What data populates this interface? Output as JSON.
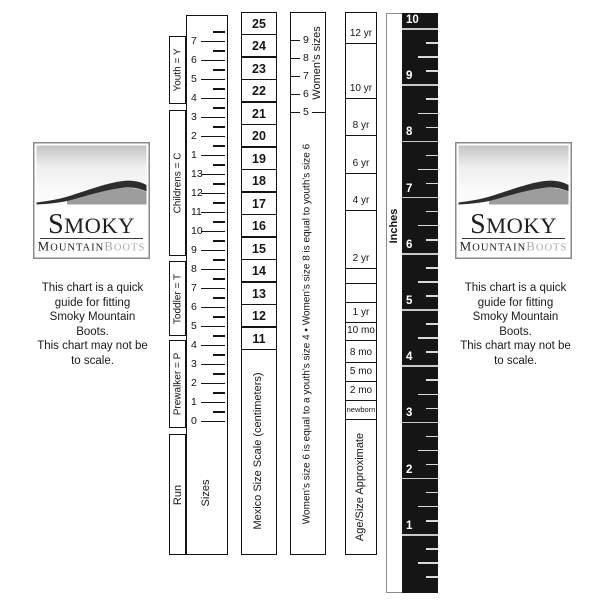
{
  "brand": {
    "name_primary": "Smoky",
    "name_secondary": "Mountain",
    "name_tertiary": "Boots"
  },
  "caption": {
    "lines": [
      "This chart is a quick",
      "guide for fitting",
      "Smoky Mountain",
      "Boots.",
      "This chart may not be",
      "to scale."
    ]
  },
  "sizes_ruler": {
    "column_label": "Run",
    "scale_label": "Sizes",
    "brackets": [
      {
        "label": "Youth = Y",
        "top": 36,
        "height": 68
      },
      {
        "label": "Childrens = C",
        "top": 110,
        "height": 146
      },
      {
        "label": "Toddler = T",
        "top": 261,
        "height": 75
      },
      {
        "label": "Prewalker = P",
        "top": 340,
        "height": 88
      }
    ],
    "ticks": [
      "7",
      "6",
      "5",
      "4",
      "3",
      "2",
      "1",
      "13",
      "12",
      "11",
      "10",
      "9",
      "8",
      "7",
      "6",
      "5",
      "4",
      "3",
      "2",
      "1",
      "0"
    ],
    "geometry": {
      "first_tick_y": 42,
      "spacing": 19
    }
  },
  "mexico_ruler": {
    "scale_label": "Mexico Size Scale (centimeters)",
    "values": [
      "25",
      "24",
      "23",
      "22",
      "21",
      "20",
      "19",
      "18",
      "17",
      "16",
      "15",
      "14",
      "13",
      "12",
      "11"
    ]
  },
  "womens_ruler": {
    "scale_label": "Women's sizes",
    "ticks": [
      "9",
      "8",
      "7",
      "6",
      "5"
    ],
    "note": "Women's size 6 is equal to a youth's size 4 • Women's size 8 is equal to youth's size 6"
  },
  "age_ruler": {
    "scale_label": "Age/Size Approximate",
    "cells": [
      {
        "label": "12 yr",
        "bottom": 43
      },
      {
        "label": "10 yr",
        "bottom": 98
      },
      {
        "label": "8 yr",
        "bottom": 135
      },
      {
        "label": "6 yr",
        "bottom": 173
      },
      {
        "label": "4 yr",
        "bottom": 210
      },
      {
        "label": "2 yr",
        "bottom": 268
      },
      {
        "label": "",
        "bottom": 283
      },
      {
        "label": "",
        "bottom": 302
      },
      {
        "label": "1 yr",
        "bottom": 322
      },
      {
        "label": "10 mo",
        "bottom": 340
      },
      {
        "label": "8 mo",
        "bottom": 362
      },
      {
        "label": "5 mo",
        "bottom": 381
      },
      {
        "label": "2 mo",
        "bottom": 400
      },
      {
        "label": "newborn",
        "bottom": 419
      }
    ]
  },
  "inches_ruler": {
    "scale_label": "Inches",
    "numbers": [
      "10",
      "9",
      "8",
      "7",
      "6",
      "5",
      "4",
      "3",
      "2",
      "1"
    ],
    "geometry": {
      "first_line_y": 29,
      "spacing": 56.2,
      "bottom_y": 591
    }
  },
  "colors": {
    "ink": "#141414",
    "ruler_black": "#151515",
    "ruler_tick_white": "#dadada",
    "logo_dark_ridge": "#2d2d2d",
    "logo_gray_ridge": "#9d9d9d",
    "logo_boots_gray": "#ababab"
  }
}
